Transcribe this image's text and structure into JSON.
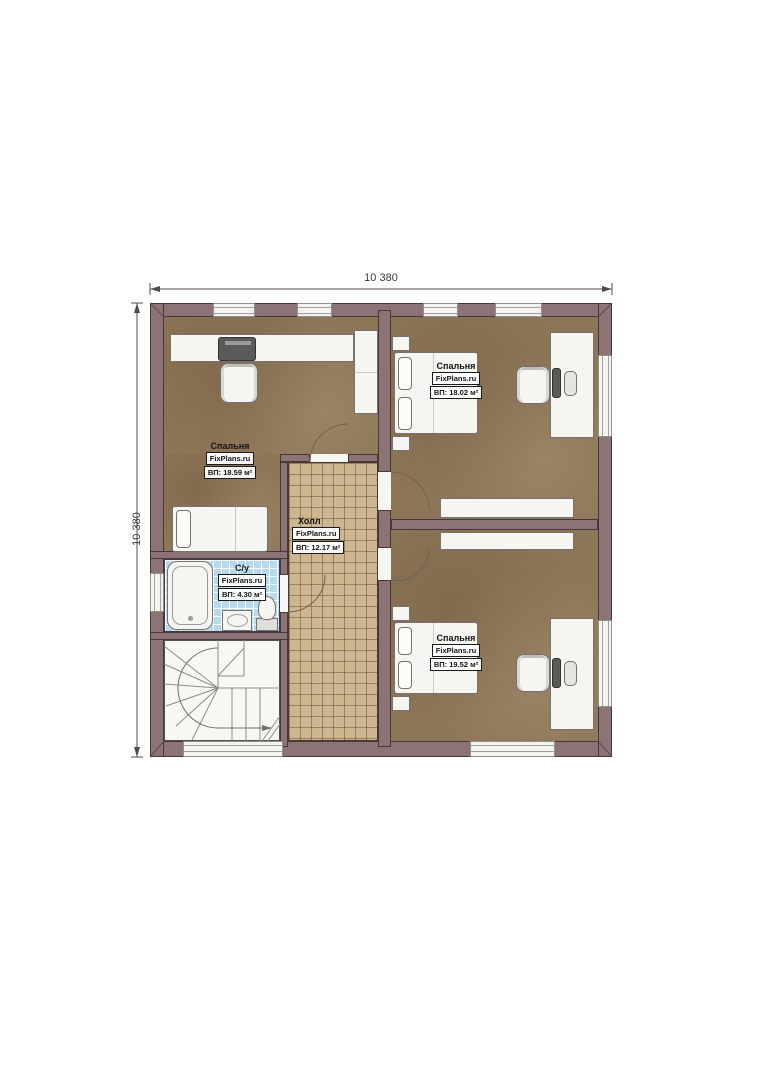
{
  "plan": {
    "branding": "FixPlans.ru",
    "dimensions": {
      "width_label": "10 380",
      "height_label": "10 380"
    },
    "rooms": [
      {
        "id": "bedroom-1",
        "name": "Спальня",
        "area": "ВП: 18.59 м²"
      },
      {
        "id": "bedroom-2",
        "name": "Спальня",
        "area": "ВП: 18.02 м²"
      },
      {
        "id": "bedroom-3",
        "name": "Спальня",
        "area": "ВП: 19.52 м²"
      },
      {
        "id": "hall",
        "name": "Холл",
        "area": "ВП: 12.17 м²"
      },
      {
        "id": "bathroom",
        "name": "С/у",
        "area": "ВП: 4.30 м²"
      }
    ],
    "colors": {
      "wall": "#8b7376",
      "wood_floor": "#8d7557",
      "hall_tile": "#cdb690",
      "bath_tile": "#b7d9ec",
      "furniture": "#f5f5f2"
    }
  }
}
